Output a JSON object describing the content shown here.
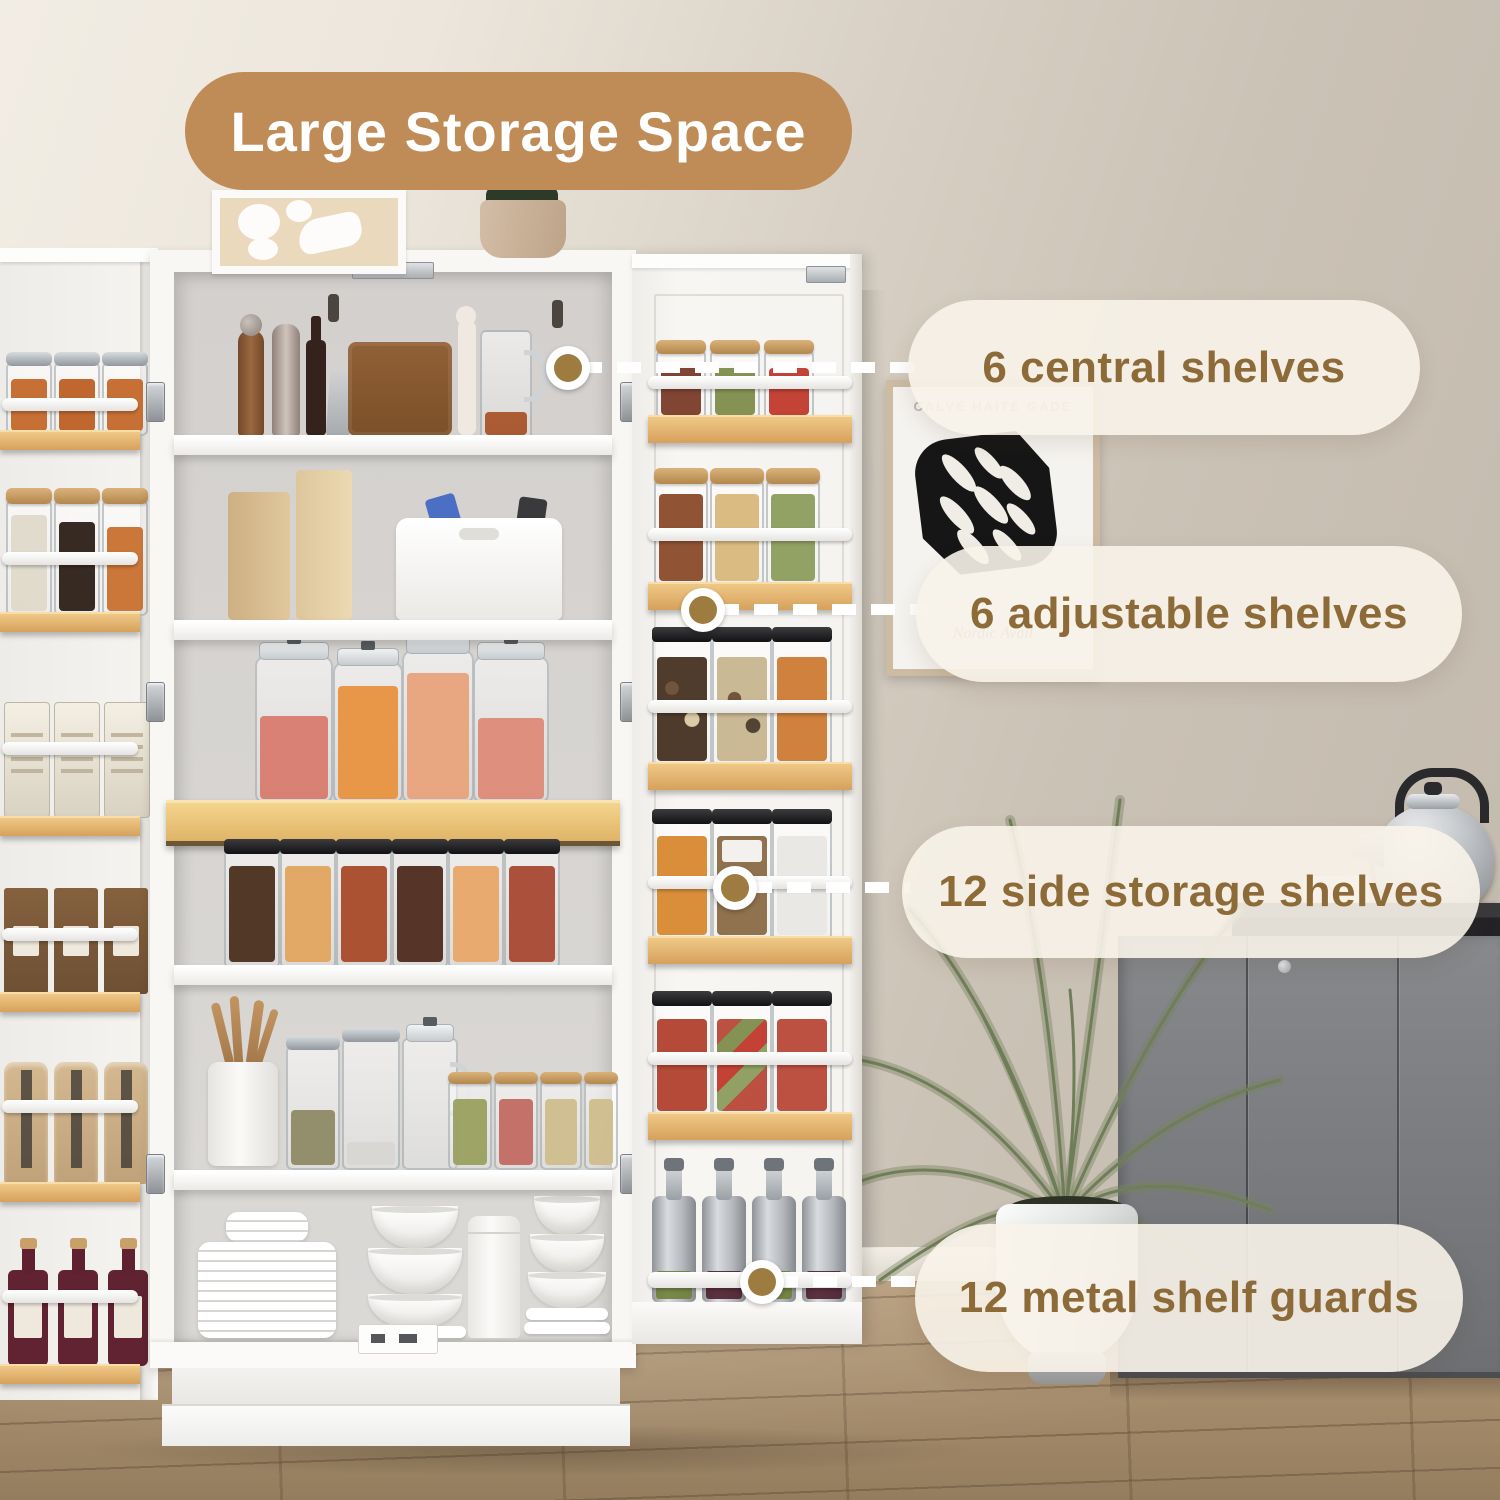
{
  "title": {
    "label": "Large Storage Space"
  },
  "callouts": [
    {
      "label": "6 central shelves"
    },
    {
      "label": "6 adjustable shelves"
    },
    {
      "label": "12 side storage shelves"
    },
    {
      "label": "12 metal shelf guards"
    }
  ],
  "wall_art": {
    "caption": "CALVE HAITE GADE",
    "signature": "Nordic Avail"
  },
  "palette": {
    "title_bg": "#bf8c57",
    "title_text": "#ffffff",
    "callout_bg": "rgba(248,243,233,0.9)",
    "callout_text": "#8d6b38",
    "connector": "#ffffff",
    "anchor_dot": "#9e7c40",
    "wall_light": "#f0ebe2",
    "wall_dark": "#c6bdb1",
    "floor_wood": "#a58c6c",
    "cabinet_white": "#f8f7f4",
    "shelf_wood": "#ddab6f",
    "gray_cabinet": "#7d8184",
    "plant_green": "#76845f"
  }
}
